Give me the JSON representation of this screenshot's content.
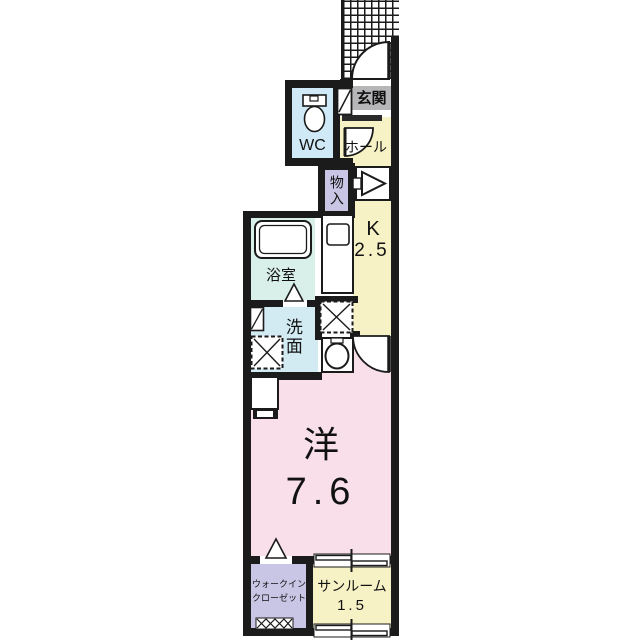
{
  "floorplan": {
    "title": "1K apartment floor plan",
    "rooms": {
      "genkan": {
        "label": "玄関"
      },
      "wc": {
        "label": "WC"
      },
      "hall": {
        "label": "ホール"
      },
      "storage": {
        "label": "物入"
      },
      "kitchen": {
        "label": "K",
        "size": "2.5"
      },
      "bath": {
        "label": "浴室"
      },
      "washroom": {
        "label": "洗面"
      },
      "western_room": {
        "label": "洋",
        "size": "7.6"
      },
      "walk_in_closet": {
        "label_line1": "ウォークイン",
        "label_line2": "クローゼット"
      },
      "sunroom": {
        "label": "サンルーム",
        "size": "1.5"
      }
    },
    "colors": {
      "wall": "#1b1b1b",
      "cream": "#f7f1c6",
      "pink": "#f9dfe9",
      "wc_blue": "#cfe9f7",
      "bath_cyan": "#d9efe9",
      "washroom_blue": "#d2eaf2",
      "purple": "#c9c6e5",
      "genkan_gray": "#b6b6b8"
    }
  }
}
